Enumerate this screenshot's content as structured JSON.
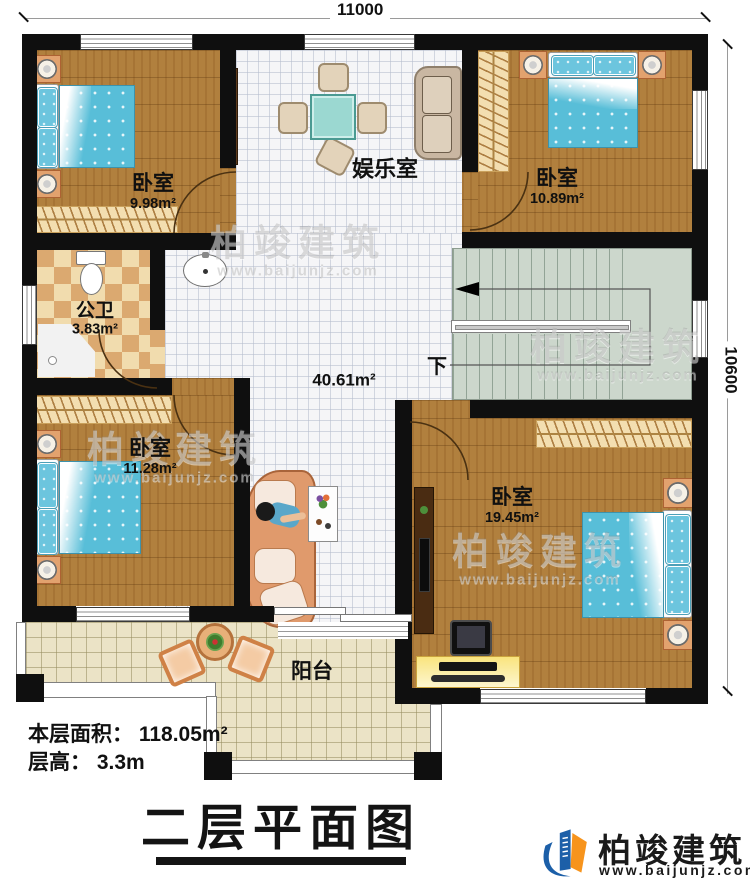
{
  "dimensions": {
    "width_mm": "11000",
    "height_mm": "10600"
  },
  "rooms": {
    "bedroom_top_left": {
      "label": "卧室",
      "area": "9.98m²"
    },
    "bedroom_top_right": {
      "label": "卧室",
      "area": "10.89m²"
    },
    "bedroom_bottom_left": {
      "label": "卧室",
      "area": "11.28m²"
    },
    "bedroom_bottom_right": {
      "label": "卧室",
      "area": "19.45m²"
    },
    "bathroom": {
      "label": "公卫",
      "area": "3.83m²"
    },
    "entertainment": {
      "label": "娱乐室"
    },
    "hall": {
      "area": "40.61m²"
    },
    "stairs": {
      "direction_label": "下"
    },
    "balcony": {
      "label": "阳台"
    }
  },
  "info": {
    "floor_area": "本层面积： 118.05m²",
    "floor_height": "层高： 3.3m"
  },
  "title": "二层平面图",
  "brand": {
    "name": "柏竣建筑",
    "url": "www.baijunjz.com"
  },
  "watermark": {
    "name": "柏竣建筑",
    "url": "www.baijunjz.com"
  },
  "colors": {
    "wall": "#0f0f0f",
    "wood_floor": "#b1803e",
    "hall_tile": "#f5f5f7",
    "bath_tile_light": "#f1dcae",
    "bath_tile_dark": "#dba970",
    "stair": "#ccd7cc",
    "bed_blue": "#58bed8",
    "balcony_tile": "#ebe3c6",
    "brand_blue": "#1c5fa8",
    "brand_orange": "#f7941d"
  }
}
